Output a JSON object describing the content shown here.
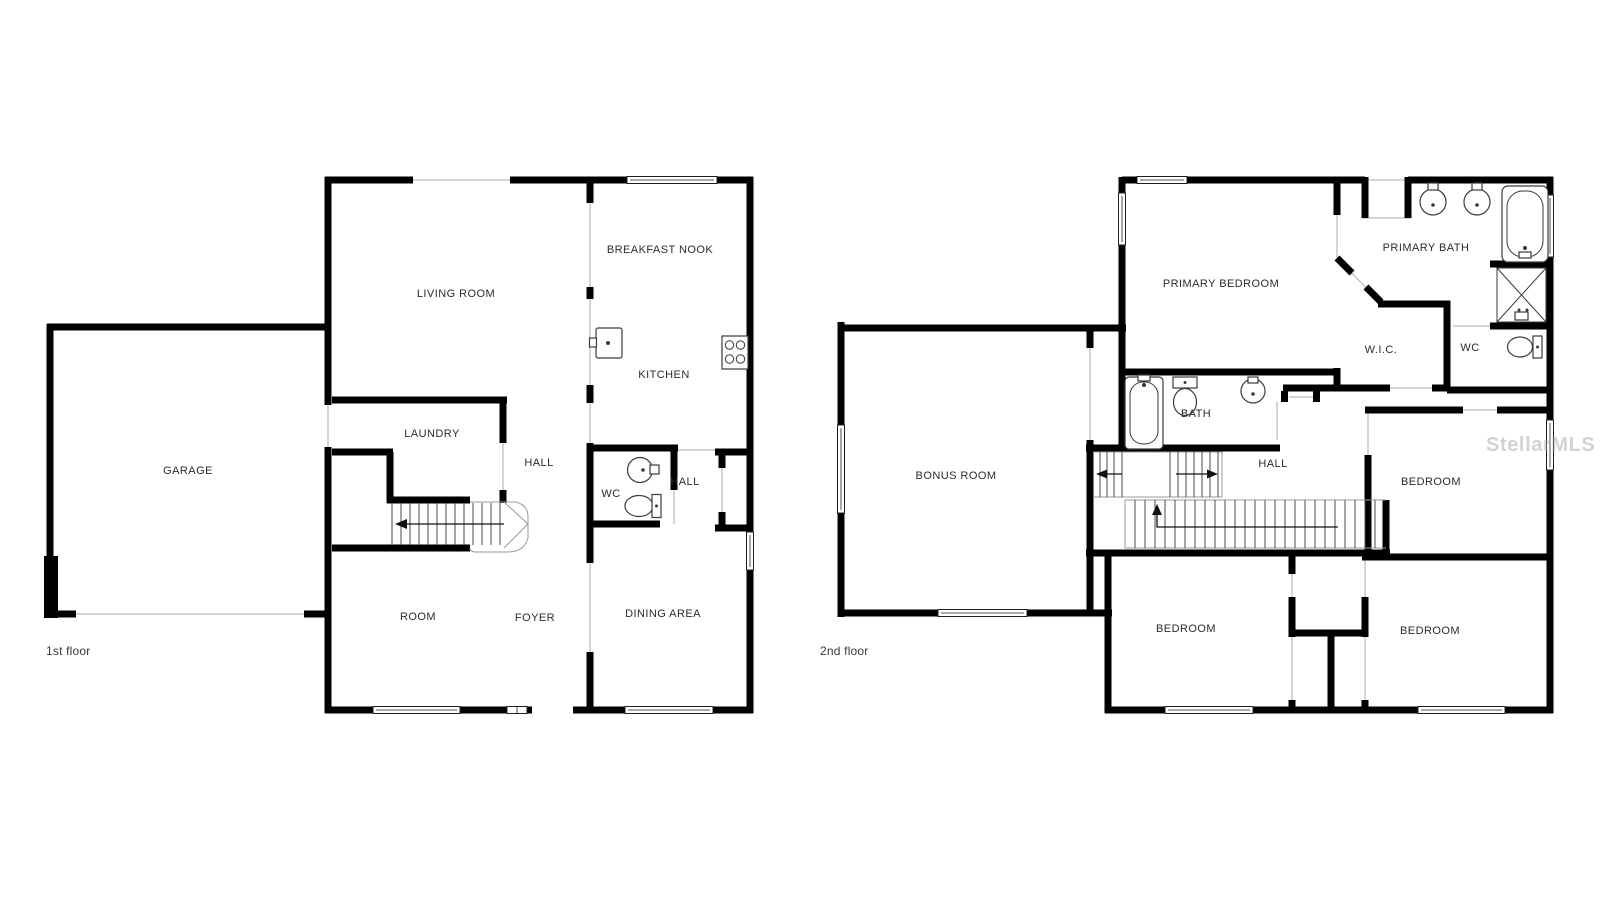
{
  "watermark": {
    "text": "StellarMLS"
  },
  "colors": {
    "wall": "#000000",
    "opening": "#c7c7c7",
    "tread": "#4a4a4a",
    "label": "#2b2b2b",
    "floor_label": "#3a3a3a",
    "watermark": "#9c9c9c"
  },
  "floors": [
    {
      "name": "1st floor",
      "rooms": [
        {
          "label": "GARAGE"
        },
        {
          "label": "LIVING ROOM"
        },
        {
          "label": "BREAKFAST NOOK"
        },
        {
          "label": "KITCHEN"
        },
        {
          "label": "LAUNDRY"
        },
        {
          "label": "HALL"
        },
        {
          "label": "WC"
        },
        {
          "label": "HALL"
        },
        {
          "label": "ROOM"
        },
        {
          "label": "FOYER"
        },
        {
          "label": "DINING AREA"
        }
      ]
    },
    {
      "name": "2nd floor",
      "rooms": [
        {
          "label": "PRIMARY BEDROOM"
        },
        {
          "label": "PRIMARY BATH"
        },
        {
          "label": "W.I.C."
        },
        {
          "label": "WC"
        },
        {
          "label": "BATH"
        },
        {
          "label": "BONUS ROOM"
        },
        {
          "label": "HALL"
        },
        {
          "label": "BEDROOM"
        },
        {
          "label": "BEDROOM"
        },
        {
          "label": "BEDROOM"
        }
      ]
    }
  ]
}
